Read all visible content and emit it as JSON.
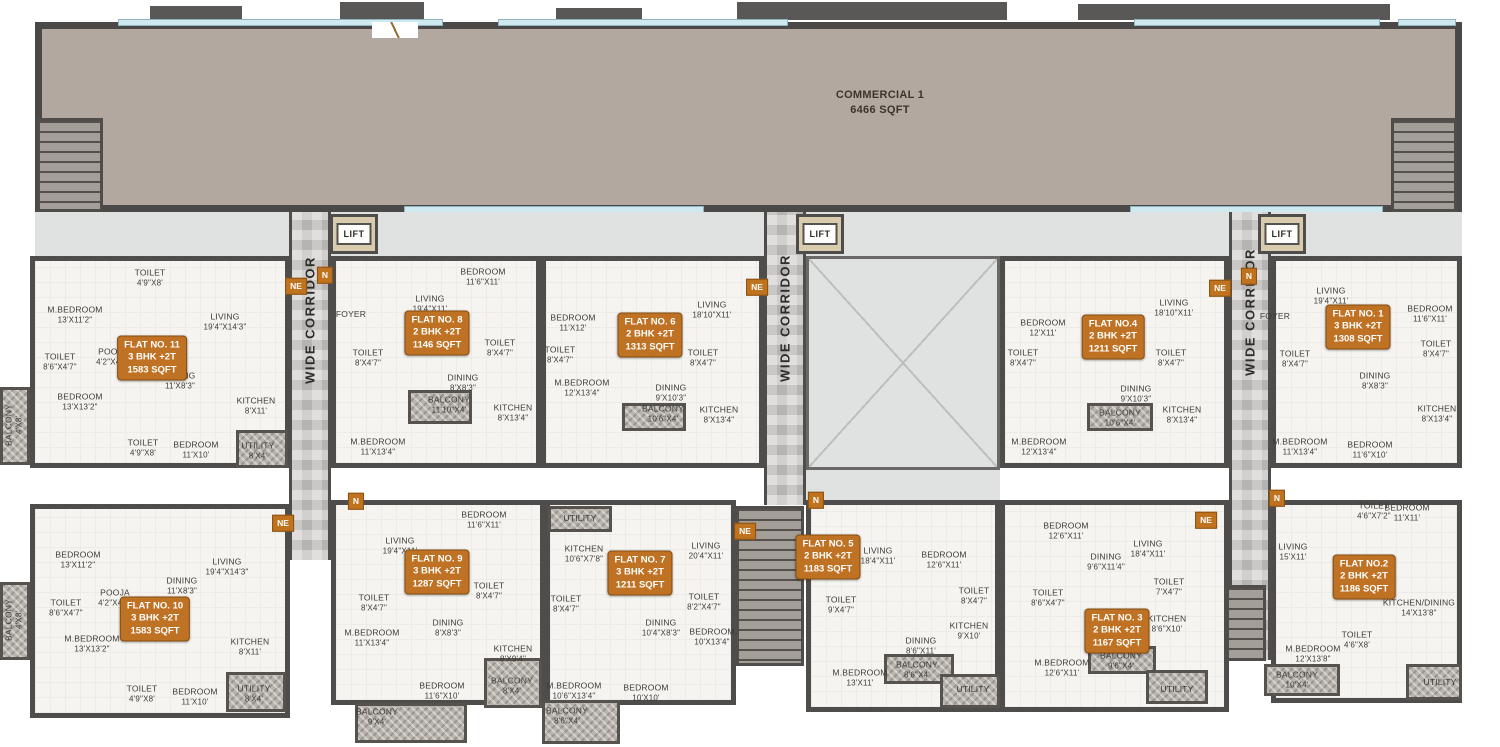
{
  "commercial": {
    "name": "COMMERCIAL 1",
    "area": "6466 SQFT"
  },
  "lift_label": "LIFT",
  "corridor_label": "WIDE CORRIDOR",
  "compass": {
    "n": "N",
    "ne": "NE"
  },
  "flats": [
    {
      "id": "flat-11",
      "title": "FLAT NO. 11",
      "config": "3 BHK +2T",
      "area": "1583 SQFT",
      "rooms": [
        {
          "name": "M.BEDROOM",
          "size": "13'X11'2\""
        },
        {
          "name": "TOILET",
          "size": "4'9\"X8'"
        },
        {
          "name": "LIVING",
          "size": "19'4\"X14'3\""
        },
        {
          "name": "POOJA",
          "size": "4'2\"X4'7\""
        },
        {
          "name": "TOILET",
          "size": "8'6\"X4'7\""
        },
        {
          "name": "DINING",
          "size": "11'X8'3\""
        },
        {
          "name": "BEDROOM",
          "size": "13'X13'2\""
        },
        {
          "name": "KITCHEN",
          "size": "8'X11'"
        },
        {
          "name": "TOILET",
          "size": "4'9\"X8'"
        },
        {
          "name": "BEDROOM",
          "size": "11'X10'"
        },
        {
          "name": "UTILITY",
          "size": "8'X4'"
        },
        {
          "name": "BALCONY",
          "size": "4'X8'"
        }
      ]
    },
    {
      "id": "flat-8",
      "title": "FLAT NO. 8",
      "config": "2 BHK +2T",
      "area": "1146 SQFT",
      "rooms": [
        {
          "name": "FOYER",
          "size": ""
        },
        {
          "name": "LIVING",
          "size": "19'4\"X11'"
        },
        {
          "name": "BEDROOM",
          "size": "11'6\"X11'"
        },
        {
          "name": "TOILET",
          "size": "8'X4'7\""
        },
        {
          "name": "TOILET",
          "size": "8'X4'7\""
        },
        {
          "name": "DINING",
          "size": "8'X8'3\""
        },
        {
          "name": "BALCONY",
          "size": "11'10\"X4'"
        },
        {
          "name": "KITCHEN",
          "size": "8'X13'4\""
        },
        {
          "name": "M.BEDROOM",
          "size": "11'X13'4\""
        }
      ]
    },
    {
      "id": "flat-6",
      "title": "FLAT NO. 6",
      "config": "2 BHK +2T",
      "area": "1313 SQFT",
      "rooms": [
        {
          "name": "BEDROOM",
          "size": "11'X12'"
        },
        {
          "name": "LIVING",
          "size": "18'10\"X11'"
        },
        {
          "name": "TOILET",
          "size": "8'X4'7\""
        },
        {
          "name": "TOILET",
          "size": "8'X4'7\""
        },
        {
          "name": "M.BEDROOM",
          "size": "12'X13'4\""
        },
        {
          "name": "DINING",
          "size": "9'X10'3\""
        },
        {
          "name": "BALCONY",
          "size": "10'6\"X4'"
        },
        {
          "name": "KITCHEN",
          "size": "8'X13'4\""
        }
      ]
    },
    {
      "id": "flat-4",
      "title": "FLAT NO.4",
      "config": "2 BHK +2T",
      "area": "1211 SQFT",
      "rooms": [
        {
          "name": "BEDROOM",
          "size": "12'X11'"
        },
        {
          "name": "LIVING",
          "size": "18'10\"X11'"
        },
        {
          "name": "TOILET",
          "size": "8'X4'7\""
        },
        {
          "name": "TOILET",
          "size": "8'X4'7\""
        },
        {
          "name": "DINING",
          "size": "9'X10'3\""
        },
        {
          "name": "BALCONY",
          "size": "10'6\"X4'"
        },
        {
          "name": "KITCHEN",
          "size": "8'X13'4\""
        },
        {
          "name": "M.BEDROOM",
          "size": "12'X13'4\""
        }
      ]
    },
    {
      "id": "flat-1",
      "title": "FLAT NO. 1",
      "config": "3 BHK +2T",
      "area": "1308 SQFT",
      "rooms": [
        {
          "name": "FOYER",
          "size": ""
        },
        {
          "name": "LIVING",
          "size": "19'4\"X11'"
        },
        {
          "name": "BEDROOM",
          "size": "11'6\"X11'"
        },
        {
          "name": "TOILET",
          "size": "8'X4'7\""
        },
        {
          "name": "TOILET",
          "size": "8'X4'7\""
        },
        {
          "name": "DINING",
          "size": "8'X8'3\""
        },
        {
          "name": "KITCHEN",
          "size": "8'X13'4\""
        },
        {
          "name": "M.BEDROOM",
          "size": "11'X13'4\""
        },
        {
          "name": "BEDROOM",
          "size": "11'6\"X10'"
        }
      ]
    },
    {
      "id": "flat-10",
      "title": "FLAT NO. 10",
      "config": "3 BHK +2T",
      "area": "1583 SQFT",
      "rooms": [
        {
          "name": "BEDROOM",
          "size": "13'X11'2\""
        },
        {
          "name": "LIVING",
          "size": "19'4\"X14'3\""
        },
        {
          "name": "DINING",
          "size": "11'X8'3\""
        },
        {
          "name": "POOJA",
          "size": "4'2\"X4'7\""
        },
        {
          "name": "TOILET",
          "size": "8'6\"X4'7\""
        },
        {
          "name": "M.BEDROOM",
          "size": "13'X13'2\""
        },
        {
          "name": "KITCHEN",
          "size": "8'X11'"
        },
        {
          "name": "TOILET",
          "size": "4'9\"X8'"
        },
        {
          "name": "BEDROOM",
          "size": "11'X10'"
        },
        {
          "name": "UTILITY",
          "size": "8'X4'"
        },
        {
          "name": "BALCONY",
          "size": "4'X8'"
        }
      ]
    },
    {
      "id": "flat-9",
      "title": "FLAT NO. 9",
      "config": "3 BHK +2T",
      "area": "1287 SQFT",
      "rooms": [
        {
          "name": "LIVING",
          "size": "19'4\"X11'"
        },
        {
          "name": "BEDROOM",
          "size": "11'6\"X11'"
        },
        {
          "name": "TOILET",
          "size": "8'X4'7\""
        },
        {
          "name": "TOILET",
          "size": "8'X4'7\""
        },
        {
          "name": "DINING",
          "size": "8'X8'3\""
        },
        {
          "name": "M.BEDROOM",
          "size": "11'X13'4\""
        },
        {
          "name": "BEDROOM",
          "size": "11'6\"X10'"
        },
        {
          "name": "KITCHEN",
          "size": "8'X9'4\""
        },
        {
          "name": "BALCONY",
          "size": "8'X4'"
        },
        {
          "name": "BALCONY",
          "size": "9'X4'"
        }
      ]
    },
    {
      "id": "flat-7",
      "title": "FLAT NO. 7",
      "config": "3 BHK +2T",
      "area": "1211 SQFT",
      "rooms": [
        {
          "name": "UTILITY",
          "size": ""
        },
        {
          "name": "KITCHEN",
          "size": "10'6\"X7'8\""
        },
        {
          "name": "LIVING",
          "size": "20'4\"X11'"
        },
        {
          "name": "TOILET",
          "size": "8'X4'7\""
        },
        {
          "name": "TOILET",
          "size": "8'2\"X4'7\""
        },
        {
          "name": "DINING",
          "size": "10'4\"X8'3\""
        },
        {
          "name": "BEDROOM",
          "size": "10'X13'4\""
        },
        {
          "name": "M.BEDROOM",
          "size": "10'6\"X13'4\""
        },
        {
          "name": "BEDROOM",
          "size": "10'X10'"
        },
        {
          "name": "BALCONY",
          "size": "8'6\"X4'"
        }
      ]
    },
    {
      "id": "flat-5",
      "title": "FLAT NO. 5",
      "config": "2 BHK +2T",
      "area": "1183 SQFT",
      "rooms": [
        {
          "name": "LIVING",
          "size": "18'4\"X11'"
        },
        {
          "name": "BEDROOM",
          "size": "12'6\"X11'"
        },
        {
          "name": "TOILET",
          "size": "9'X4'7\""
        },
        {
          "name": "TOILET",
          "size": "8'X4'7\""
        },
        {
          "name": "KITCHEN",
          "size": "9'X10'"
        },
        {
          "name": "DINING",
          "size": "8'6\"X11'"
        },
        {
          "name": "M.BEDROOM",
          "size": "13'X11'"
        },
        {
          "name": "BALCONY",
          "size": "8'6\"X4'"
        },
        {
          "name": "UTILITY",
          "size": ""
        }
      ]
    },
    {
      "id": "flat-3",
      "title": "FLAT NO. 3",
      "config": "2 BHK +2T",
      "area": "1167 SQFT",
      "rooms": [
        {
          "name": "BEDROOM",
          "size": "12'6\"X11'"
        },
        {
          "name": "DINING",
          "size": "9'6\"X11'4\""
        },
        {
          "name": "LIVING",
          "size": "18'4\"X11'"
        },
        {
          "name": "TOILET",
          "size": "8'6\"X4'7\""
        },
        {
          "name": "TOILET",
          "size": "7'X4'7\""
        },
        {
          "name": "KITCHEN",
          "size": "8'6\"X10'"
        },
        {
          "name": "M.BEDROOM",
          "size": "12'6\"X11'"
        },
        {
          "name": "BALCONY",
          "size": "9'6\"X4'"
        },
        {
          "name": "UTILITY",
          "size": ""
        }
      ]
    },
    {
      "id": "flat-2",
      "title": "FLAT NO.2",
      "config": "2 BHK +2T",
      "area": "1186 SQFT",
      "rooms": [
        {
          "name": "LIVING",
          "size": "15'X11'"
        },
        {
          "name": "TOILET",
          "size": "4'6\"X7'2\""
        },
        {
          "name": "BEDROOM",
          "size": "11'X11'"
        },
        {
          "name": "KITCHEN/DINING",
          "size": "14'X13'8\""
        },
        {
          "name": "TOILET",
          "size": "4'6\"X8'"
        },
        {
          "name": "M.BEDROOM",
          "size": "12'X13'8\""
        },
        {
          "name": "BALCONY",
          "size": "10'X4'"
        },
        {
          "name": "UTILITY",
          "size": ""
        }
      ]
    }
  ]
}
